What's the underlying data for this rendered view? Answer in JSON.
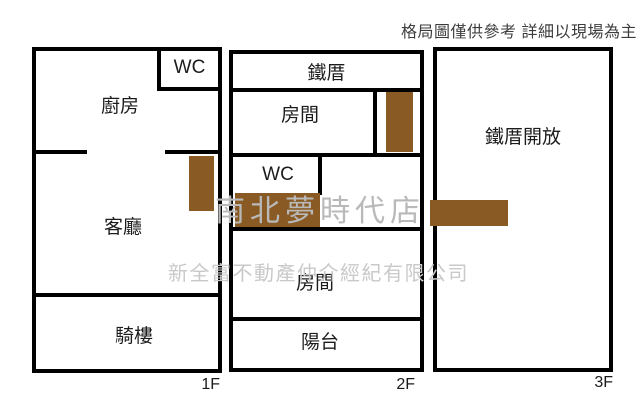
{
  "header": {
    "notice": "格局圖僅供參考 詳細以現場為主"
  },
  "watermark": {
    "line1": "南北夢時代店",
    "line2": "新全富不動產仲介經紀有限公司"
  },
  "colors": {
    "wall": "#000000",
    "stair": "#8a5a24",
    "notice": "#3d3d3d",
    "watermark1": "#b9b9b9",
    "watermark2": "#c9c9c9"
  },
  "floors": [
    {
      "label": "1F",
      "rooms": {
        "kitchen": "廚房",
        "wc": "WC",
        "living": "客廳",
        "arcade": "騎樓"
      }
    },
    {
      "label": "2F",
      "rooms": {
        "iron_shed": "鐵厝",
        "room_upper": "房間",
        "wc": "WC",
        "room_lower": "房間",
        "balcony": "陽台"
      }
    },
    {
      "label": "3F",
      "rooms": {
        "open_iron_shed": "鐵厝開放"
      }
    }
  ]
}
